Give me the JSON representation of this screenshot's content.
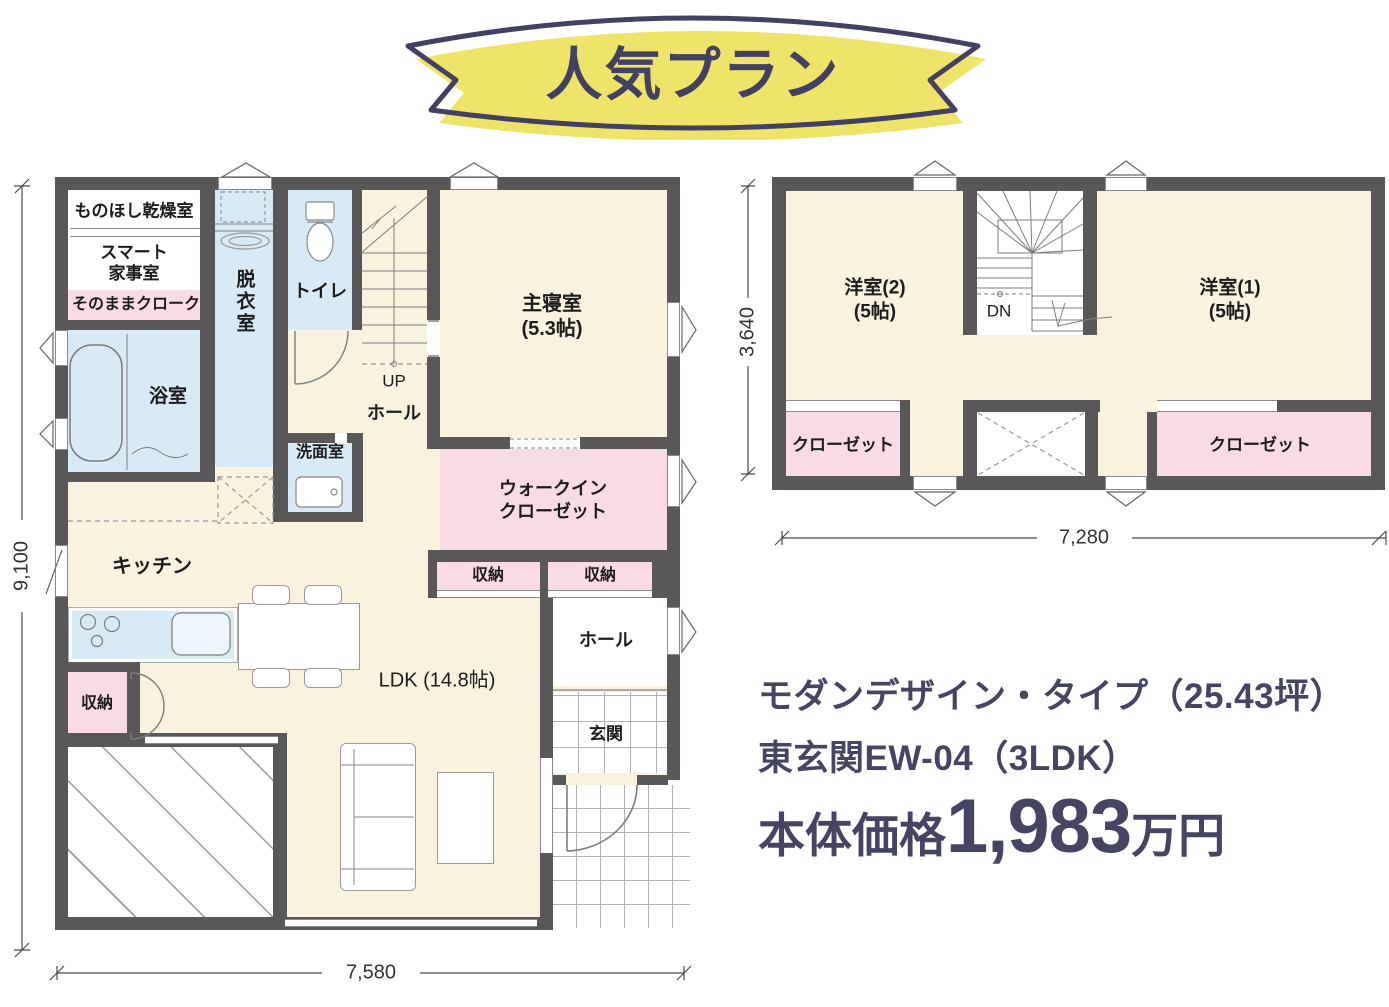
{
  "banner": {
    "label": "人気プラン"
  },
  "colors": {
    "wall": "#595757",
    "floor_cream": "#f8f2df",
    "wet_blue": "#d8eaf6",
    "closet_pink": "#f9dbe6",
    "banner_yellow": "#efe46a",
    "navy_text": "#454462"
  },
  "floor1": {
    "labels": {
      "monohoshi": "ものほし乾燥室",
      "smart": "スマート\n家事室",
      "cloak": "そのままクローク",
      "bath": "浴室",
      "datsui": "脱衣室",
      "toilet": "トイレ",
      "up": "UP",
      "hall_upper": "ホール",
      "senmen": "洗面室",
      "bedroom": "主寝室\n(5.3帖)",
      "wic": "ウォークイン\nクローゼット",
      "storage_a": "収納",
      "storage_b": "収納",
      "storage_bl": "収納",
      "kitchen": "キッチン",
      "ldk": "LDK (14.8帖)",
      "hall_lower": "ホール",
      "genkan": "玄関"
    },
    "dims": {
      "height": "9,100",
      "width": "7,580"
    }
  },
  "floor2": {
    "labels": {
      "room2": "洋室(2)\n(5帖)",
      "dn": "DN",
      "room1": "洋室(1)\n(5帖)",
      "closet_left": "クローゼット",
      "closet_right": "クローゼット"
    },
    "dims": {
      "height": "3,640",
      "width": "7,280"
    }
  },
  "info": {
    "line1": "モダンデザイン・タイプ（25.43坪）",
    "line2": "東玄関EW-04（3LDK）",
    "price_label": "本体価格",
    "price_value": "1,983",
    "price_unit": "万円"
  }
}
